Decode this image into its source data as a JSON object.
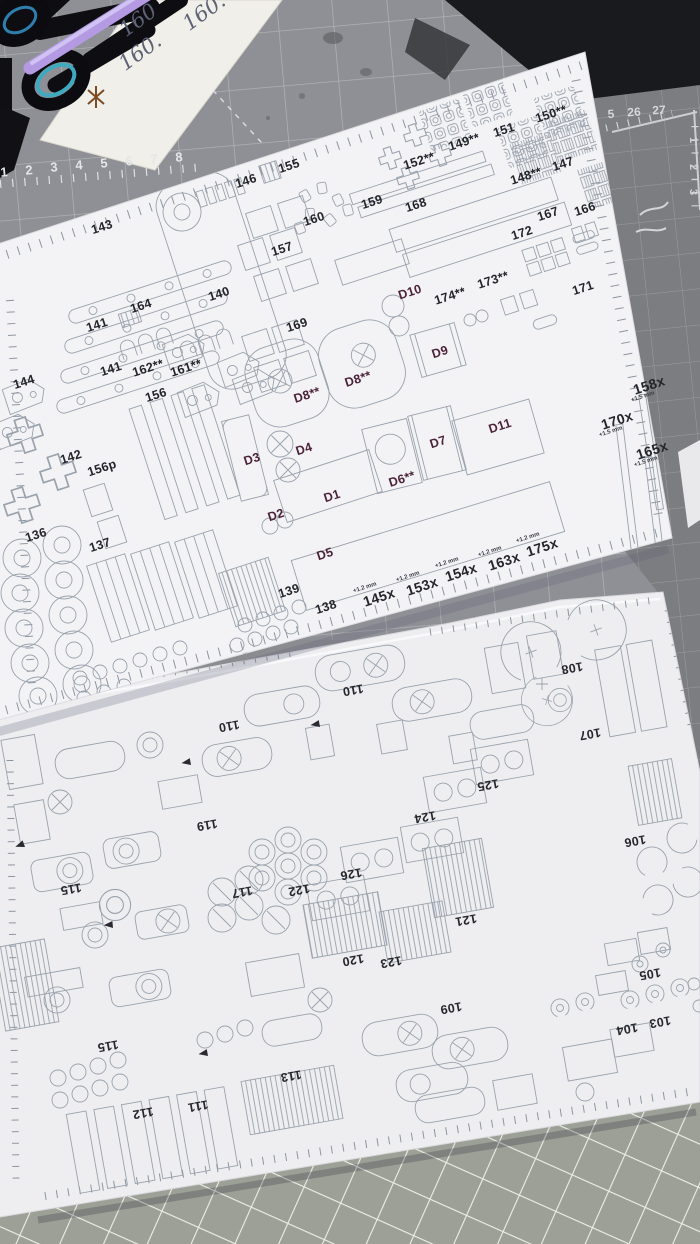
{
  "handwritten_note": {
    "texts": [
      "160",
      "160.",
      "160."
    ]
  },
  "cutting_mat": {
    "top_ruler_numbers": [
      "1",
      "2",
      "3",
      "4",
      "5",
      "6",
      "7",
      "8"
    ],
    "corner_numbers": [
      "5",
      "26",
      "27"
    ],
    "vertical_numbers": [
      "1",
      "2",
      "3"
    ]
  },
  "annotations": {
    "offset_small": "+1.2 mm",
    "offset_large": "+1.5 mm"
  },
  "top_sheet": {
    "labels": [
      "143",
      "146",
      "155",
      "160",
      "159",
      "157",
      "140",
      "164",
      "141",
      "169",
      "152**",
      "149**",
      "151",
      "150**",
      "148**",
      "147",
      "168",
      "172",
      "167",
      "166",
      "171",
      "D10",
      "174**",
      "173**",
      "D8**",
      "D8**",
      "D9",
      "144",
      "141",
      "162**",
      "161**",
      "156",
      "142",
      "156p",
      "D3",
      "D4",
      "D1",
      "D2",
      "D6**",
      "D7",
      "D11",
      "D5",
      "158x",
      "170x",
      "165x",
      "136",
      "137",
      "139",
      "138",
      "145x",
      "153x",
      "154x",
      "163x",
      "175x"
    ]
  },
  "bottom_sheet": {
    "labels": [
      "108",
      "110",
      "110",
      "107",
      "125",
      "124",
      "119",
      "106",
      "115",
      "117",
      "122",
      "126",
      "121",
      "120",
      "123",
      "105",
      "109",
      "103",
      "104",
      "115",
      "112",
      "111",
      "113"
    ]
  }
}
